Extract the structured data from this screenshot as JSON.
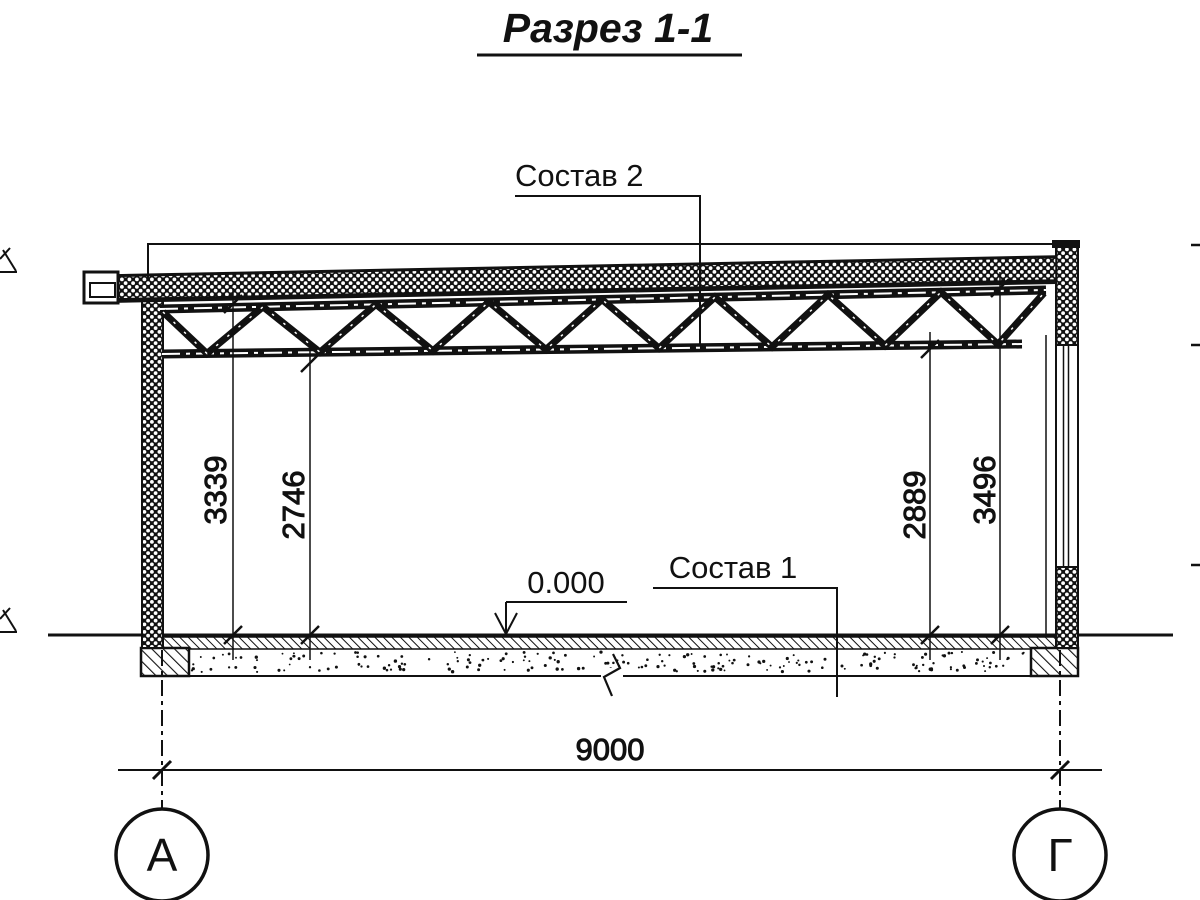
{
  "title": "Разрез 1-1",
  "labels": {
    "roof_composition": "Состав 2",
    "floor_composition": "Состав 1",
    "zero_level": "0.000"
  },
  "dimensions": {
    "left_outer": "3339",
    "left_inner": "2746",
    "right_inner": "2889",
    "right_outer": "3496",
    "span": "9000"
  },
  "axes": {
    "left": "А",
    "right": "Г"
  },
  "colors": {
    "ink": "#111111",
    "paper": "#ffffff"
  }
}
